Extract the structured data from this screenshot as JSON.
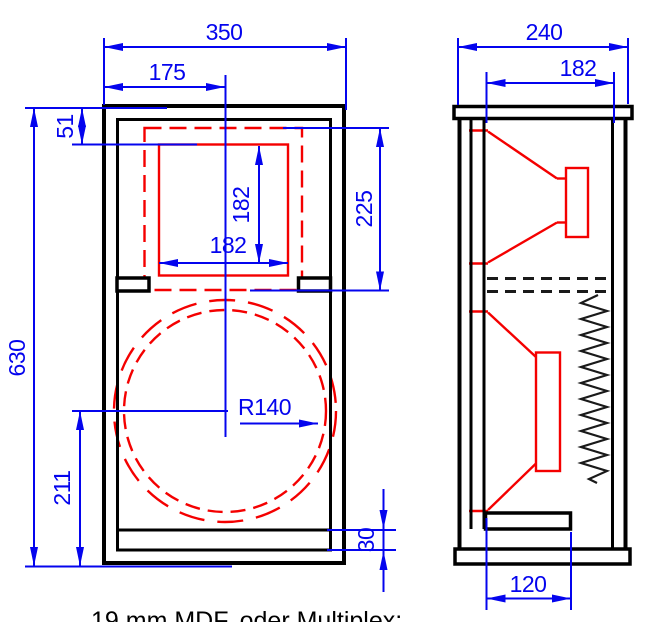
{
  "caption": "19 mm MDF, oder Multiplex:",
  "colors": {
    "dimension_blue": "#0404ee",
    "cutout_red": "#f40000",
    "outline_black": "#000000",
    "background": "#ffffff"
  },
  "front_view": {
    "dim_width": "350",
    "dim_center_offset": "175",
    "dim_top_offset": "51",
    "dim_height": "630",
    "dim_mid_cutout_width": "182",
    "dim_mid_cutout_height": "182",
    "dim_chamber_height": "225",
    "dim_woofer_center_height": "211",
    "dim_bottom_shelf_thickness": "30",
    "dim_woofer_radius": "R140"
  },
  "side_view": {
    "dim_depth": "240",
    "dim_inner_depth": "182",
    "dim_port_shelf_length": "120"
  }
}
